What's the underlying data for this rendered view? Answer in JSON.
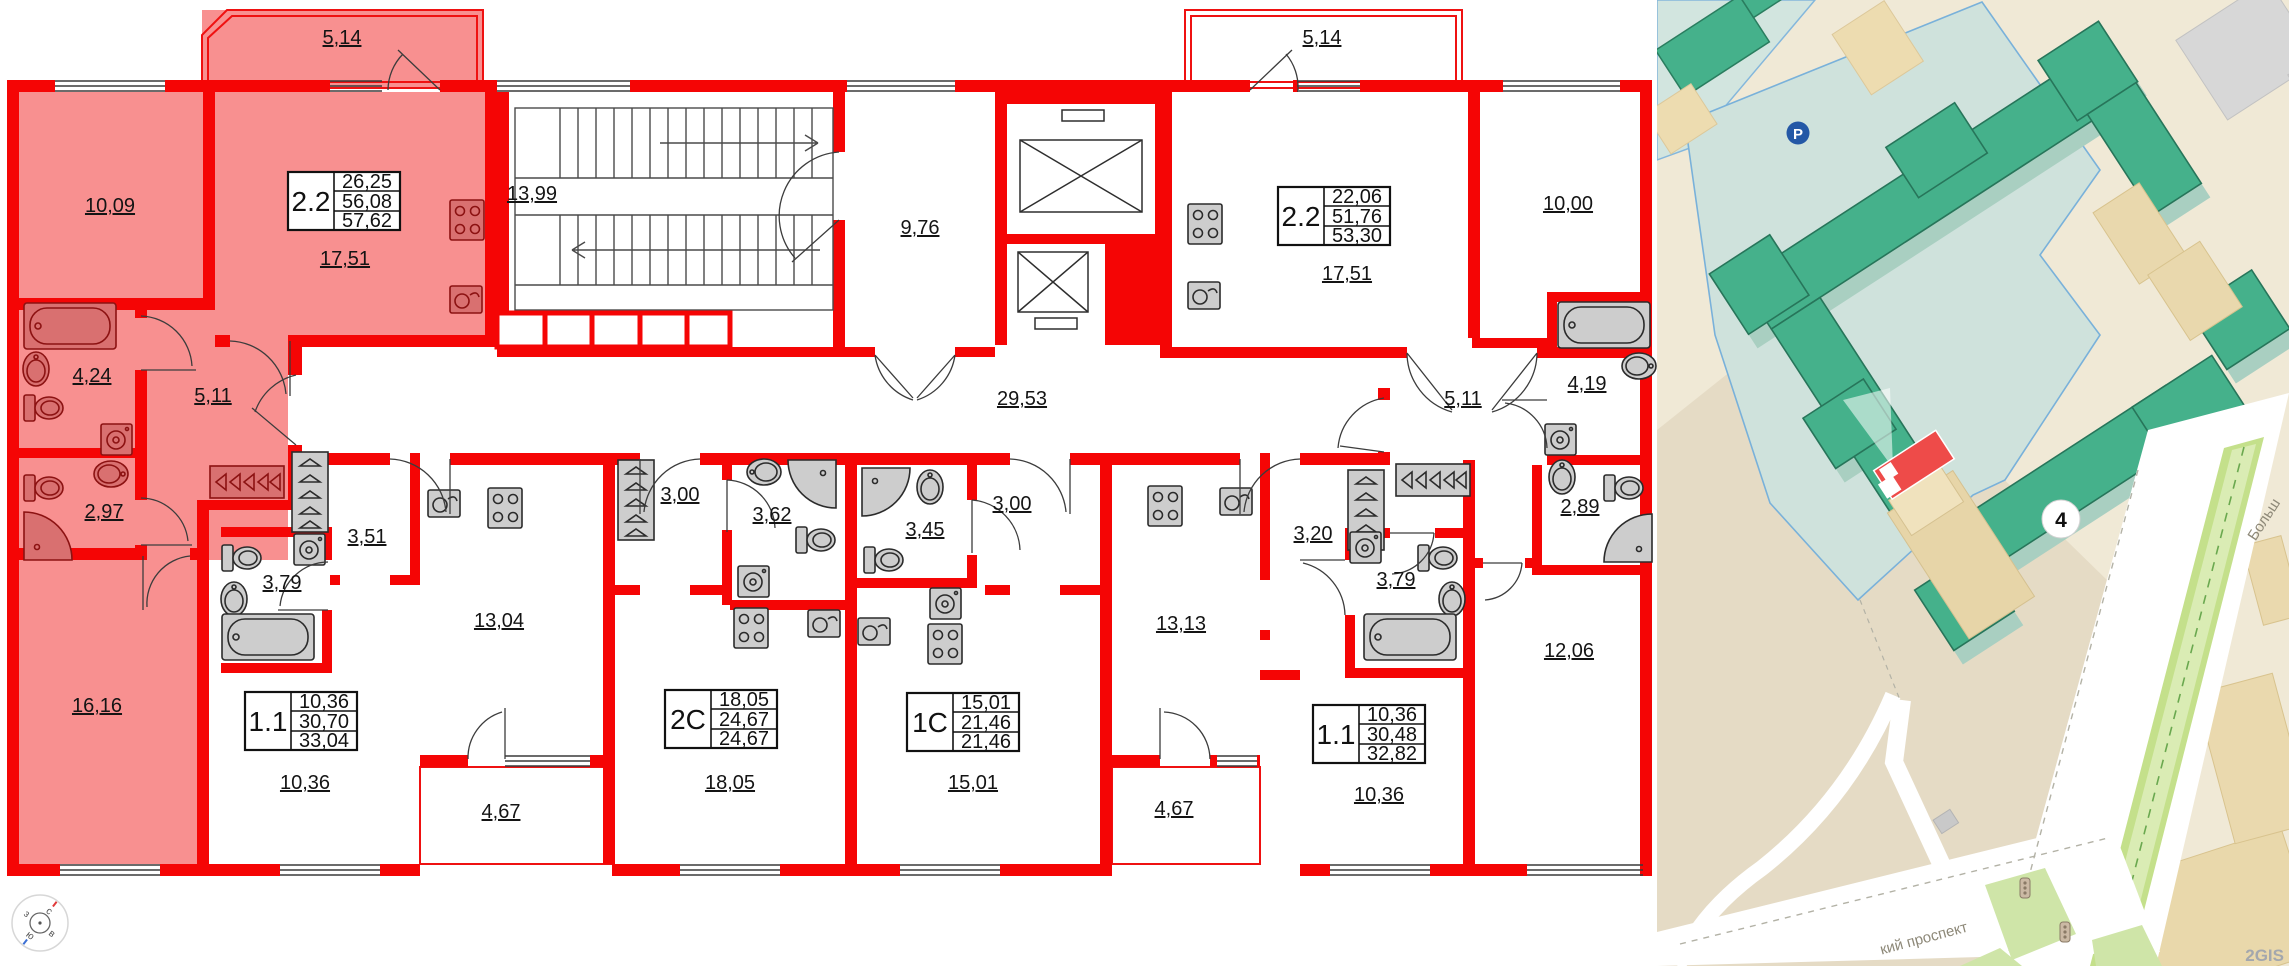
{
  "floorplan": {
    "compass": {
      "n": "с",
      "e": "в",
      "s": "ю",
      "w": "з"
    },
    "common": {
      "stairwell": "13,99",
      "entrance_hall": "9,76",
      "corridor": "29,53"
    },
    "apartments": [
      {
        "id": "apt-2.2-left",
        "type": "2.2",
        "selected": true,
        "stats": {
          "living": "26,25",
          "area": "56,08",
          "total": "57,62"
        },
        "rooms": {
          "balcony": "5,14",
          "bedroom": "10,09",
          "kitchen_living": "17,51",
          "bathroom": "4,24",
          "hall": "5,11",
          "wc": "2,97",
          "room": "16,16"
        }
      },
      {
        "id": "apt-1.1-left",
        "type": "1.1",
        "selected": false,
        "stats": {
          "living": "10,36",
          "area": "30,70",
          "total": "33,04"
        },
        "rooms": {
          "hall": "3,51",
          "bathroom": "3,79",
          "kitchen_living": "13,04",
          "room": "10,36",
          "balcony": "4,67"
        }
      },
      {
        "id": "apt-2s",
        "type": "2С",
        "selected": false,
        "stats": {
          "living": "18,05",
          "area": "24,67",
          "total": "24,67"
        },
        "rooms": {
          "hall": "3,00",
          "bathroom": "3,62",
          "kitchen_living": "18,05"
        }
      },
      {
        "id": "apt-1s",
        "type": "1С",
        "selected": false,
        "stats": {
          "living": "15,01",
          "area": "21,46",
          "total": "21,46"
        },
        "rooms": {
          "bathroom": "3,45",
          "hall": "3,00",
          "kitchen_living": "15,01"
        }
      },
      {
        "id": "apt-1.1-right",
        "type": "1.1",
        "selected": false,
        "stats": {
          "living": "10,36",
          "area": "30,48",
          "total": "32,82"
        },
        "rooms": {
          "hall": "3,20",
          "bathroom": "3,79",
          "kitchen_living": "13,13",
          "room": "10,36",
          "balcony": "4,67"
        }
      },
      {
        "id": "apt-2.2-right",
        "type": "2.2",
        "selected": false,
        "stats": {
          "living": "22,06",
          "area": "51,76",
          "total": "53,30"
        },
        "rooms": {
          "balcony": "5,14",
          "kitchen_living": "17,51",
          "bedroom": "10,00",
          "bathroom": "4,19",
          "hall": "5,11",
          "wc": "2,89",
          "room": "12,06"
        }
      }
    ]
  },
  "map": {
    "parking_badge": "P",
    "building_number": "4",
    "street_label_1": "Больш",
    "street_label_2": "кий проспект",
    "attribution": "2GIS"
  },
  "colors": {
    "wall_red": "#f50505",
    "selected_fill": "#f89090",
    "map_background": "#f0e9d6",
    "map_parcel": "#cfe2dc",
    "map_parcel_outline": "#79b1da",
    "map_building_green": "#45b18b",
    "highlight_red": "#ee4b49",
    "parking_blue": "#2458a6"
  }
}
